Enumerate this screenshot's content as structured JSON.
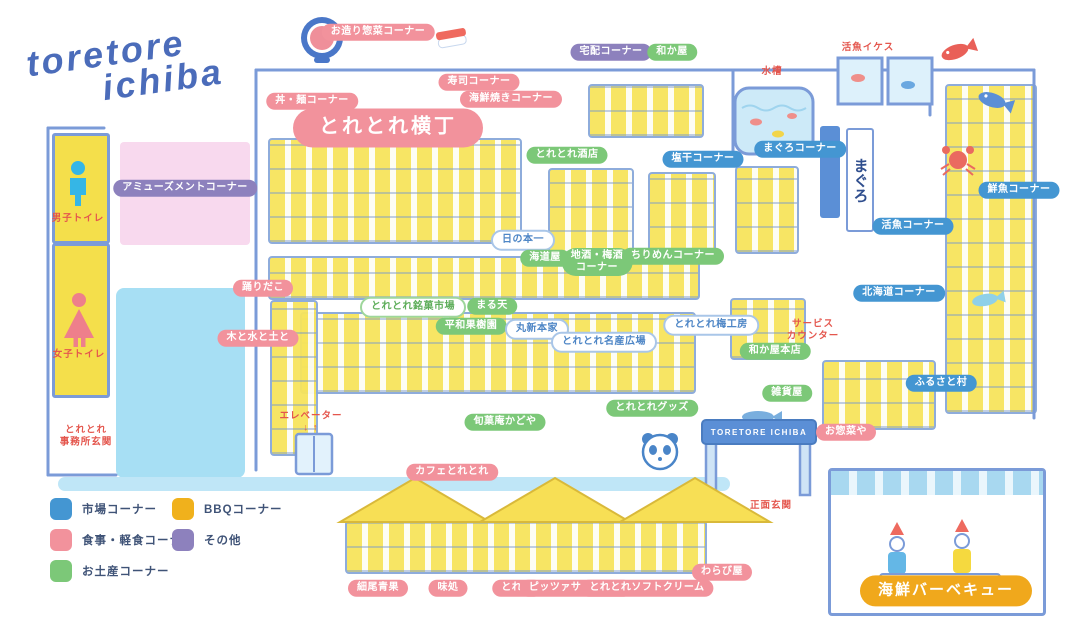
{
  "title": {
    "logo_line1": "toretore",
    "logo_line2": "ichiba"
  },
  "signs": {
    "gate": "TORETORE ICHIBA",
    "maguro_banner": "まぐろ"
  },
  "colors": {
    "market_blue": "#4496d2",
    "food_pink": "#f2929c",
    "souvenir_green": "#7cc878",
    "bbq_gold": "#f0a81c",
    "other_purple": "#8d81bd",
    "red_note": "#e4564d",
    "outline_blue": "#7b9bd8",
    "logo_blue": "#4b6cba"
  },
  "legend": {
    "items": [
      {
        "name": "legend-market",
        "label": "市場コーナー",
        "color": "#4496d2",
        "col": 0,
        "row": 0
      },
      {
        "name": "legend-bbq",
        "label": "BBQコーナー",
        "color": "#f0b11c",
        "col": 1,
        "row": 0
      },
      {
        "name": "legend-food",
        "label": "食事・軽食コーナー",
        "color": "#f2929c",
        "col": 0,
        "row": 1
      },
      {
        "name": "legend-other",
        "label": "その他",
        "color": "#8d81bd",
        "col": 1,
        "row": 1
      },
      {
        "name": "legend-souvenir",
        "label": "お土産コーナー",
        "color": "#7cc878",
        "col": 0,
        "row": 2
      }
    ]
  },
  "pills": [
    {
      "name": "ozukuri-sozai-corner",
      "text": "お造り惣菜コーナー",
      "category": "food",
      "x": 378,
      "y": 32
    },
    {
      "name": "don-men-corner",
      "text": "丼・麺コーナー",
      "category": "food",
      "x": 312,
      "y": 101
    },
    {
      "name": "sushi-corner",
      "text": "寿司コーナー",
      "category": "food",
      "x": 479,
      "y": 82
    },
    {
      "name": "kaisen-yaki-corner",
      "text": "海鮮焼きコーナー",
      "category": "food",
      "x": 511,
      "y": 99
    },
    {
      "name": "toretore-yokocho",
      "text": "とれとれ横丁",
      "category": "food",
      "variant": "variant-large",
      "x": 388,
      "y": 128
    },
    {
      "name": "takuhai-corner",
      "text": "宅配コーナー",
      "category": "other",
      "x": 611,
      "y": 52
    },
    {
      "name": "wakaya",
      "text": "和か屋",
      "category": "souvenir",
      "x": 672,
      "y": 52
    },
    {
      "name": "toretore-saketen",
      "text": "とれとれ酒店",
      "category": "souvenir",
      "x": 567,
      "y": 155
    },
    {
      "name": "shiohoshi-corner",
      "text": "塩干コーナー",
      "category": "market",
      "x": 703,
      "y": 159
    },
    {
      "name": "maguro-corner",
      "text": "まぐろコーナー",
      "category": "market",
      "x": 800,
      "y": 149
    },
    {
      "name": "katsugyo-corner",
      "text": "活魚コーナー",
      "category": "market",
      "x": 913,
      "y": 226
    },
    {
      "name": "sengyo-corner",
      "text": "鮮魚コーナー",
      "category": "market",
      "x": 1019,
      "y": 190
    },
    {
      "name": "hinomoto-ichi",
      "text": "日の本一",
      "category": "outline-blue",
      "x": 523,
      "y": 240
    },
    {
      "name": "kaidoya",
      "text": "海道屋",
      "category": "souvenir",
      "x": 545,
      "y": 258
    },
    {
      "name": "jizake-umeshu-corner",
      "text": "地酒・梅酒\nコーナー",
      "category": "souvenir",
      "x": 597,
      "y": 262
    },
    {
      "name": "chirimen-corner",
      "text": "ちりめんコーナー",
      "category": "souvenir",
      "x": 673,
      "y": 256
    },
    {
      "name": "hokkaido-corner",
      "text": "北海道コーナー",
      "category": "market",
      "x": 899,
      "y": 293
    },
    {
      "name": "odoridako",
      "text": "踊りだこ",
      "category": "food",
      "x": 263,
      "y": 288
    },
    {
      "name": "toretore-meika-ichiba",
      "text": "とれとれ銘菓市場",
      "category": "outline-green",
      "x": 413,
      "y": 307
    },
    {
      "name": "maruten",
      "text": "まる天",
      "category": "souvenir",
      "x": 492,
      "y": 306
    },
    {
      "name": "ki-to-mizu-to-tsuchi",
      "text": "木と水と土と",
      "category": "food",
      "x": 258,
      "y": 338
    },
    {
      "name": "heiwa-kajuen",
      "text": "平和果樹園",
      "category": "souvenir",
      "x": 471,
      "y": 326
    },
    {
      "name": "marushin-honke",
      "text": "丸新本家",
      "category": "outline-blue",
      "x": 537,
      "y": 329
    },
    {
      "name": "toretore-meisan-hiroba",
      "text": "とれとれ名産広場",
      "category": "outline-blue",
      "x": 604,
      "y": 342
    },
    {
      "name": "toretore-ume-kobo",
      "text": "とれとれ梅工房",
      "category": "outline-blue",
      "x": 711,
      "y": 325
    },
    {
      "name": "wakaya-honten",
      "text": "和か屋本店",
      "category": "souvenir",
      "x": 775,
      "y": 351
    },
    {
      "name": "furusato-mura",
      "text": "ふるさと村",
      "category": "market",
      "x": 941,
      "y": 383
    },
    {
      "name": "zakkaya",
      "text": "雑貨屋",
      "category": "souvenir",
      "x": 787,
      "y": 393
    },
    {
      "name": "toretore-goods",
      "text": "とれとれグッズ",
      "category": "souvenir",
      "x": 652,
      "y": 408
    },
    {
      "name": "shunkaan-kadoya",
      "text": "旬菓庵かどや",
      "category": "souvenir",
      "x": 505,
      "y": 422
    },
    {
      "name": "osozaiya",
      "text": "お惣菜や",
      "category": "food",
      "x": 846,
      "y": 432
    },
    {
      "name": "cafe-toretore",
      "text": "カフェとれとれ",
      "category": "food",
      "x": 452,
      "y": 472
    },
    {
      "name": "warabiya",
      "text": "わらび屋",
      "category": "food",
      "x": 722,
      "y": 572
    },
    {
      "name": "hosoo-seika",
      "text": "細尾青果",
      "category": "food",
      "x": 378,
      "y": 588
    },
    {
      "name": "ajidokoro",
      "text": "味処",
      "category": "food",
      "x": 448,
      "y": 588
    },
    {
      "name": "toreten",
      "text": "とれ天",
      "category": "food",
      "x": 517,
      "y": 588
    },
    {
      "name": "pizza-san-marco",
      "text": "ピッツァサンマルコ",
      "category": "food",
      "x": 576,
      "y": 588
    },
    {
      "name": "toretore-soft-cream",
      "text": "とれとれソフトクリーム",
      "category": "food",
      "x": 647,
      "y": 588
    },
    {
      "name": "kaisen-bbq",
      "text": "海鮮バーベキュー",
      "category": "bbq",
      "variant": "variant-bbq",
      "x": 946,
      "y": 591
    },
    {
      "name": "amusement-corner",
      "text": "アミューズメントコーナー",
      "category": "other",
      "x": 185,
      "y": 188
    }
  ],
  "notes": [
    {
      "name": "mens-toilet-label",
      "text": "男子トイレ",
      "x": 78,
      "y": 219
    },
    {
      "name": "womens-toilet-label",
      "text": "女子トイレ",
      "x": 79,
      "y": 355
    },
    {
      "name": "office-entrance-label",
      "text": "とれとれ\n事務所玄関",
      "x": 86,
      "y": 437
    },
    {
      "name": "elevator-label",
      "text": "エレベーター\n↓ ↑",
      "x": 311,
      "y": 423
    },
    {
      "name": "suiso-label",
      "text": "水槽",
      "x": 772,
      "y": 72
    },
    {
      "name": "katsugyo-ikesu-label",
      "text": "活魚イケス",
      "x": 868,
      "y": 48
    },
    {
      "name": "service-counter-label",
      "text": "サービス\nカウンター",
      "x": 813,
      "y": 331
    },
    {
      "name": "front-entrance-label",
      "text": "正面玄関",
      "x": 771,
      "y": 506
    }
  ]
}
